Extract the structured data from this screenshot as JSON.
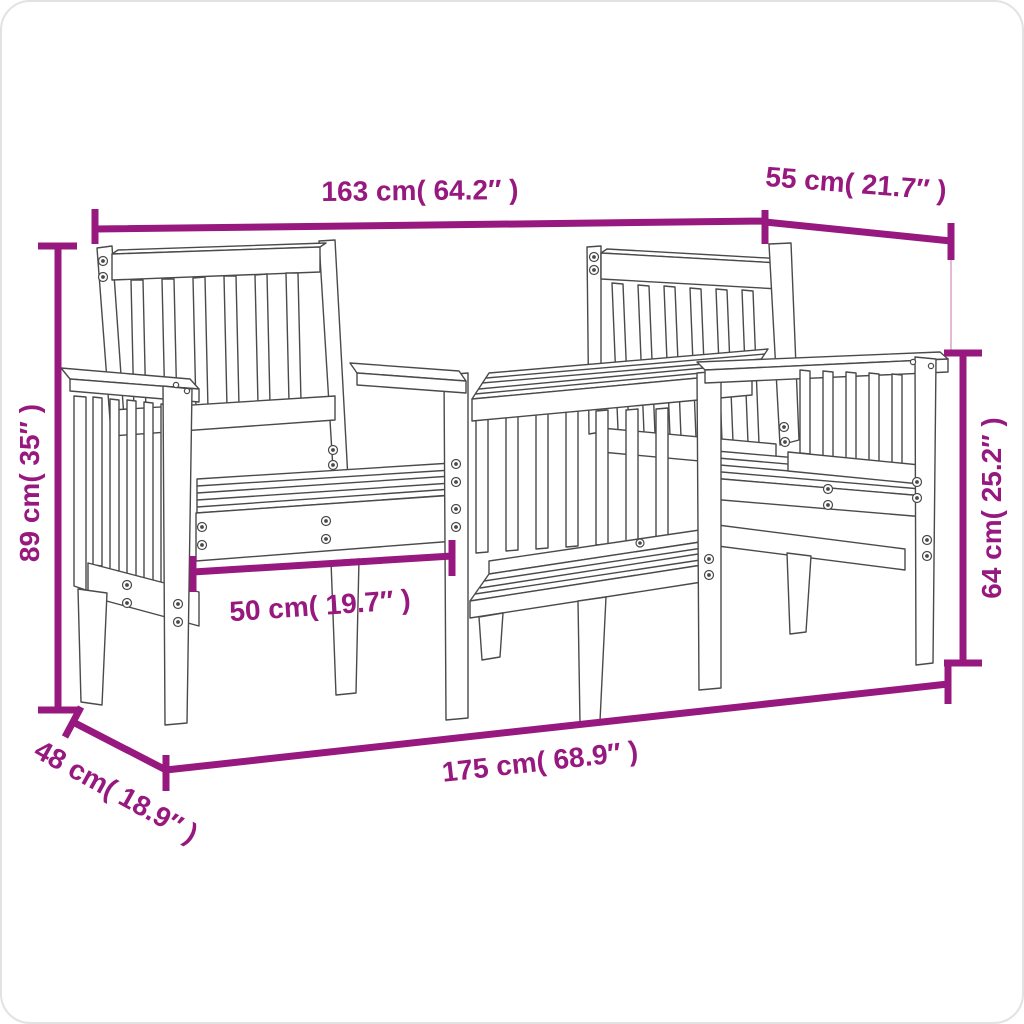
{
  "figure": {
    "type": "product-dimension-diagram",
    "subject": "wooden 2-seater garden bench with center tea table",
    "colors": {
      "dimension": "#97187E",
      "dimension_light": "#DCA8CE",
      "line_art": "#4A4A4A",
      "background": "#FFFFFF"
    },
    "dimensions": [
      {
        "id": "overall-width",
        "label": "163 cm( 64.2″ )",
        "cm": 163,
        "inches": 64.2
      },
      {
        "id": "seat-depth-top",
        "label": "55 cm( 21.7″ )",
        "cm": 55,
        "inches": 21.7
      },
      {
        "id": "back-height",
        "label": "89 cm( 35″ )",
        "cm": 89,
        "inches": 35
      },
      {
        "id": "armrest-height",
        "label": "64 cm( 25.2″ )",
        "cm": 64,
        "inches": 25.2
      },
      {
        "id": "seat-width",
        "label": "50 cm( 19.7″ )",
        "cm": 50,
        "inches": 19.7
      },
      {
        "id": "base-depth",
        "label": "48 cm( 18.9″ )",
        "cm": 48,
        "inches": 18.9
      },
      {
        "id": "base-width",
        "label": "175 cm( 68.9″ )",
        "cm": 175,
        "inches": 68.9
      }
    ]
  }
}
